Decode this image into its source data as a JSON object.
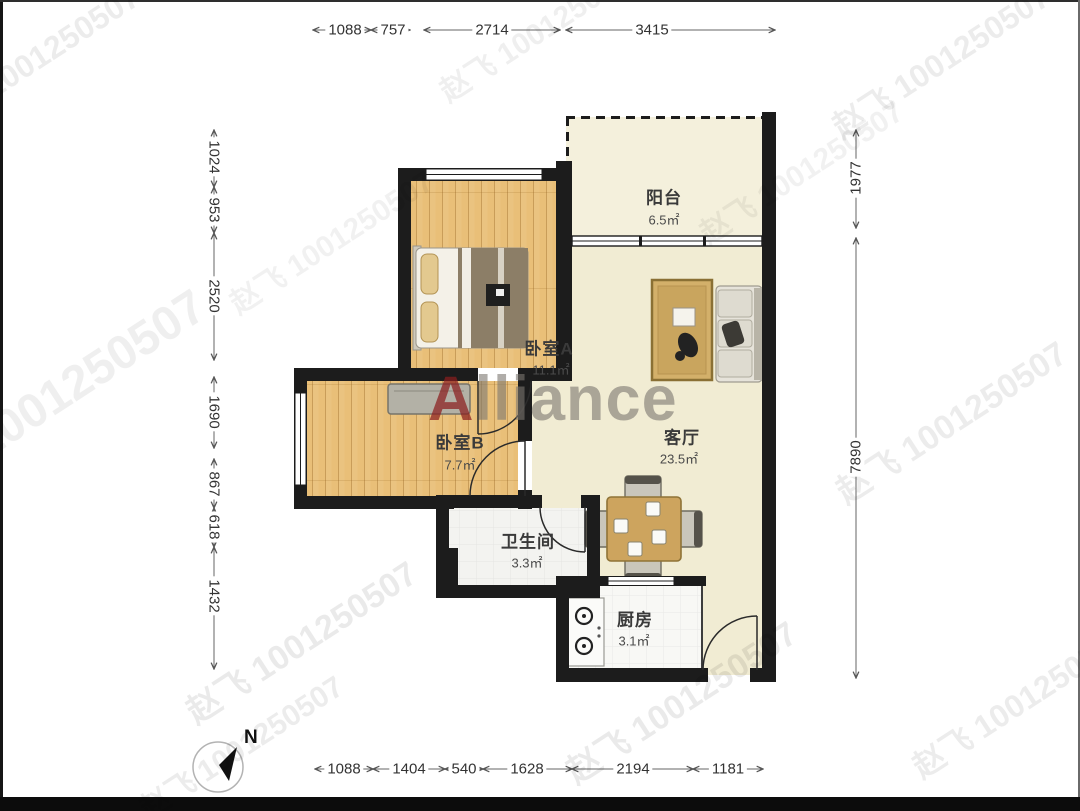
{
  "watermark_text": "赵飞 1001250507",
  "brand": {
    "first_letter": "A",
    "rest": "lliance"
  },
  "compass": {
    "label": "N"
  },
  "rooms": {
    "balcony": {
      "name": "阳台",
      "area": "6.5㎡"
    },
    "bedroomA": {
      "name": "卧室A",
      "area": "11.1㎡"
    },
    "living": {
      "name": "客厅",
      "area": "23.5㎡"
    },
    "bedroomB": {
      "name": "卧室B",
      "area": "7.7㎡"
    },
    "bathroom": {
      "name": "卫生间",
      "area": "3.3㎡"
    },
    "kitchen": {
      "name": "厨房",
      "area": "3.1㎡"
    }
  },
  "dimensions": {
    "top": [
      "1088",
      "757",
      "2714",
      "3415"
    ],
    "bottom": [
      "1088",
      "1404",
      "540",
      "1628",
      "2194",
      "1181"
    ],
    "left": [
      "1024",
      "953",
      "2520",
      "1690",
      "867",
      "618",
      "1432"
    ],
    "right": [
      "1977",
      "7890"
    ]
  },
  "colors": {
    "wall": "#1c1c1c",
    "wood_floor": "#e9bf78",
    "living_floor": "#f1ecd3",
    "balcony_floor": "#f4f0dc",
    "tile_floor": "#f3f3f0",
    "brand_red": "#8a1e1e",
    "dim_line": "#555555"
  }
}
